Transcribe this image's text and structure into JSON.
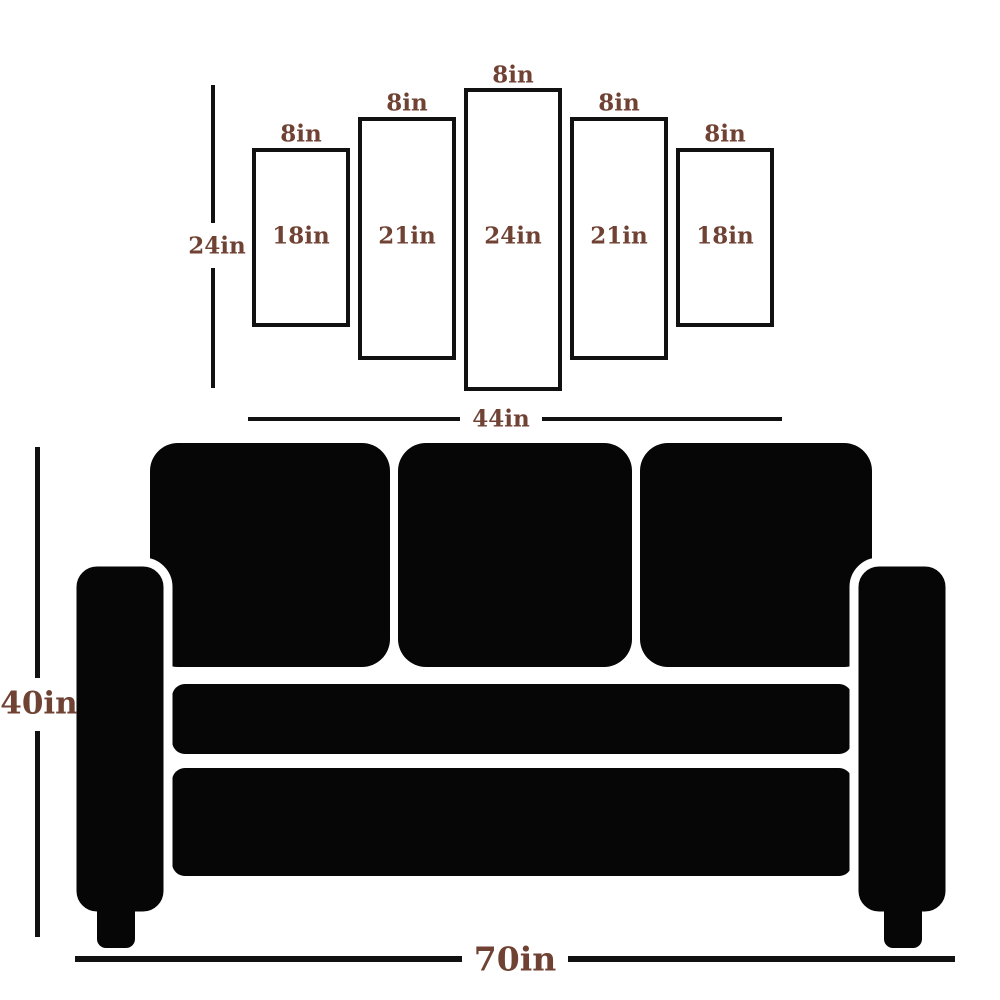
{
  "diagram": {
    "panel_set": {
      "height_dimension": "24in",
      "width_dimension": "44in",
      "panels": [
        {
          "width": "8in",
          "height": "18in"
        },
        {
          "width": "8in",
          "height": "21in"
        },
        {
          "width": "8in",
          "height": "24in"
        },
        {
          "width": "8in",
          "height": "21in"
        },
        {
          "width": "8in",
          "height": "18in"
        }
      ]
    },
    "sofa": {
      "height_dimension": "40in",
      "width_dimension": "70in"
    }
  },
  "colors": {
    "dimension_text": "#6f4233",
    "line": "#111111",
    "sofa": "#060606",
    "background": "#ffffff",
    "panel_fill": "#ffffff",
    "panel_border": "#111111"
  }
}
